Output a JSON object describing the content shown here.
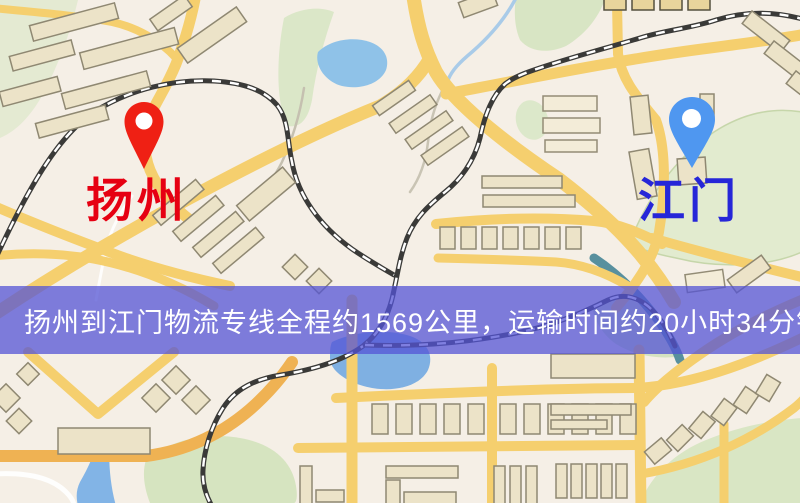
{
  "markers": {
    "origin": {
      "label": "扬州",
      "pin_color": "#ef2014",
      "label_color": "#e60012"
    },
    "destination": {
      "label": "江门",
      "pin_color": "#4f97f0",
      "label_color": "#2626d8"
    }
  },
  "banner": {
    "text": "扬州到江门物流专线全程约1569公里，运输时间约20小时34分钟.",
    "origin": "扬州",
    "destination": "江门",
    "service_type": "物流专线",
    "distance_km": "1569",
    "duration": "20小时34分钟",
    "background_color": "rgba(84,84,213,0.75)",
    "text_color": "#ffffff"
  },
  "map_palette": {
    "background": "#f5efe6",
    "road_yellow": "#f5cf6e",
    "road_orange": "#efb253",
    "water_blue": "#8fc2e8",
    "park_green": "#d9e6c4",
    "building_fill": "#ece3c8",
    "building_stroke": "#8f8872",
    "railway_dark": "#3a3a38"
  }
}
